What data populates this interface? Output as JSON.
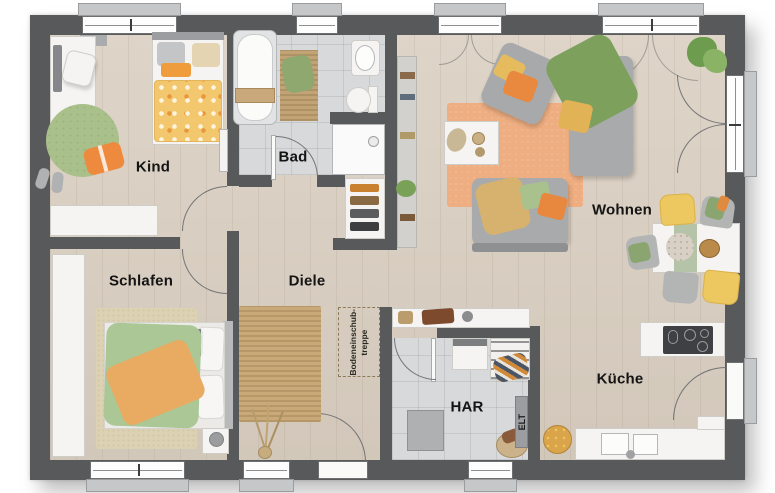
{
  "type": "floor-plan",
  "rooms": {
    "kind": {
      "label": "Kind"
    },
    "bad": {
      "label": "Bad"
    },
    "wohnen": {
      "label": "Wohnen"
    },
    "schlafen": {
      "label": "Schlafen"
    },
    "diele": {
      "label": "Diele"
    },
    "har": {
      "label": "HAR"
    },
    "kueche": {
      "label": "Küche"
    }
  },
  "annotations": {
    "attic_stair": {
      "line1": "Bodeneinschub-",
      "line2": "treppe"
    },
    "electrical": {
      "label": "ELT"
    }
  },
  "colors": {
    "wall": "#58595b",
    "wood_floor": "#d9cec0",
    "tile_floor": "#d7d9db",
    "accent_orange": "#e8873f",
    "accent_yellow": "#eec45e",
    "accent_green": "#a4bd86",
    "rug_jute": "#c8a977"
  }
}
